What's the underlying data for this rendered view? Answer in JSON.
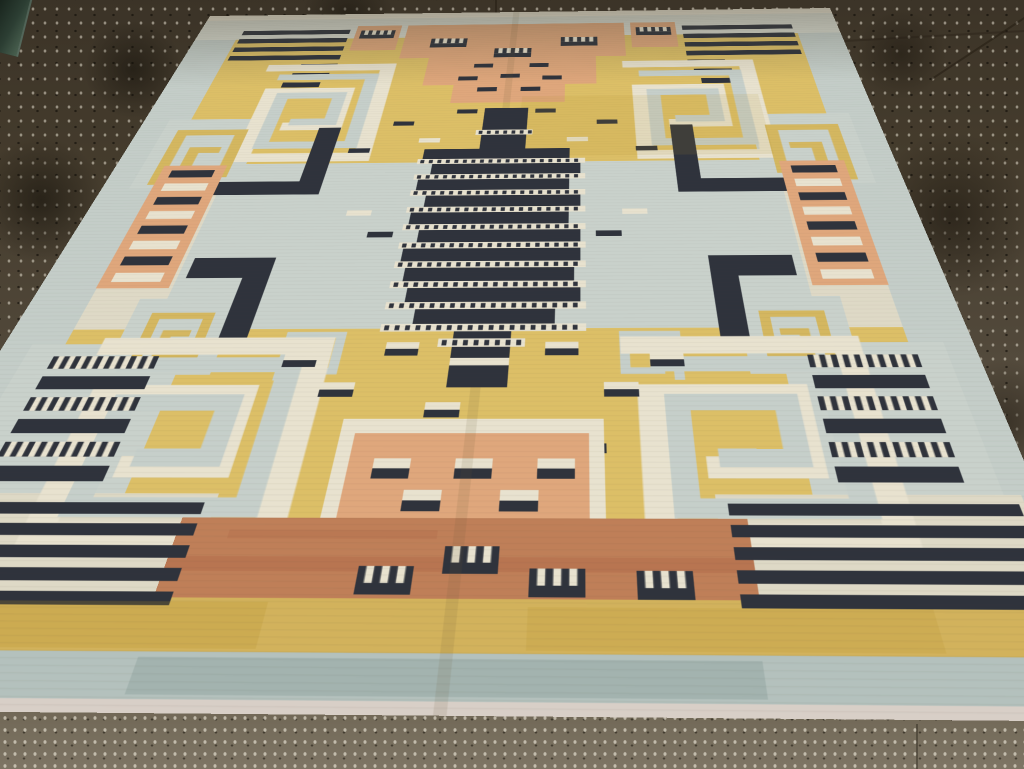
{
  "scene": {
    "type": "photograph",
    "subject": "Art Deco flat-weave dhurrie rug with geometric motifs, shown in perspective on a dark speckled concrete floor",
    "motif_vocabulary": [
      "greek-key spirals",
      "comb piano-key devices",
      "striped totem column",
      "salmon ladders",
      "stepped salmon blocks",
      "navy stripe stacks",
      "scattered two-tone dashes"
    ]
  },
  "palette": {
    "floor_top": "#3b3327",
    "floor_mid": "#6f6553",
    "floor_bottom": "#7d7464",
    "speckle_light": "rgba(238,232,216,0.5)",
    "speckle_dark": "rgba(15,12,7,0.6)",
    "grout": "#241e13",
    "cream": "#ded9c6",
    "cream_motif": "#e8e2cf",
    "selvage": "#e9e3d2",
    "white_band": "#d8dacf",
    "pale_edge": "#d8cfc7",
    "gray": "#c4cdc8",
    "gray_field": "#c9d1cb",
    "gray_deep": "#b4c1bd",
    "gray_key": "#c6cfca",
    "yellow": "#dcbf67",
    "yellow_deep": "#d2b25c",
    "yellow_key": "#d4b760",
    "gold": "#b8922f",
    "salmon": "#dfa77c",
    "terracotta": "#bf7f58",
    "red_streak": "#a85f41",
    "navy": "#2f333c",
    "teal_streak": "#7e948e",
    "fold": "#6b5a36"
  },
  "rug": {
    "size": [
      1000,
      1300
    ],
    "corners_px": [
      [
        210,
        16
      ],
      [
        830,
        8
      ],
      [
        1136,
        722
      ],
      [
        -225,
        710
      ]
    ],
    "zones": [
      {
        "x": 0,
        "y": 0,
        "w": 1000,
        "h": 1300,
        "c": "cream"
      },
      {
        "x": 0,
        "y": 0,
        "w": 1000,
        "h": 95,
        "c": "white_band"
      },
      {
        "x": 0,
        "y": 0,
        "w": 1000,
        "h": 20,
        "c": "selvage"
      },
      {
        "x": 0,
        "y": 95,
        "w": 65,
        "h": 1150,
        "c": "gray"
      },
      {
        "x": 935,
        "y": 95,
        "w": 65,
        "h": 1150,
        "c": "gray"
      },
      {
        "x": 65,
        "y": 95,
        "w": 870,
        "h": 390,
        "c": "yellow"
      },
      {
        "x": 150,
        "y": 485,
        "w": 700,
        "h": 350,
        "c": "gray_field"
      },
      {
        "x": 65,
        "y": 485,
        "w": 85,
        "h": 350,
        "c": "cream"
      },
      {
        "x": 850,
        "y": 485,
        "w": 85,
        "h": 350,
        "c": "cream"
      },
      {
        "x": 65,
        "y": 835,
        "w": 870,
        "h": 357,
        "c": "yellow"
      },
      {
        "x": 0,
        "y": 1192,
        "w": 1000,
        "h": 53,
        "c": "yellow_deep"
      },
      {
        "x": 0,
        "y": 1245,
        "w": 1000,
        "h": 43,
        "c": "gray_deep"
      },
      {
        "x": 0,
        "y": 1288,
        "w": 1000,
        "h": 12,
        "c": "pale_edge"
      },
      {
        "x": 35,
        "y": 360,
        "w": 135,
        "h": 185,
        "c": "gray_field"
      },
      {
        "x": 830,
        "y": 360,
        "w": 135,
        "h": 185,
        "c": "gray_field"
      },
      {
        "x": 120,
        "y": 780,
        "w": 110,
        "h": 130,
        "c": "gray_field"
      },
      {
        "x": 770,
        "y": 780,
        "w": 110,
        "h": 130,
        "c": "gray_field"
      },
      {
        "x": 30,
        "y": 860,
        "w": 165,
        "h": 235,
        "c": "gray_field"
      },
      {
        "x": 805,
        "y": 860,
        "w": 165,
        "h": 235,
        "c": "gray_field"
      },
      {
        "x": 15,
        "y": 1075,
        "w": 265,
        "h": 117,
        "c": "cream"
      },
      {
        "x": 720,
        "y": 1075,
        "w": 265,
        "h": 117,
        "c": "cream"
      }
    ],
    "motifs": [
      {
        "t": "stripes",
        "x": 70,
        "y": 62,
        "w": 170,
        "h": 16,
        "n": 4,
        "gap": 15,
        "c": "navy"
      },
      {
        "t": "stripes",
        "x": 760,
        "y": 62,
        "w": 170,
        "h": 16,
        "n": 4,
        "gap": 15,
        "c": "navy"
      },
      {
        "t": "dash",
        "x": 185,
        "y": 186,
        "w": 55,
        "h": 16
      },
      {
        "t": "dash",
        "x": 178,
        "y": 217,
        "w": 55,
        "h": 16
      },
      {
        "t": "dash",
        "x": 170,
        "y": 248,
        "w": 55,
        "h": 16
      },
      {
        "t": "dash",
        "x": 760,
        "y": 186,
        "w": 55,
        "h": 16
      },
      {
        "t": "dash",
        "x": 767,
        "y": 217,
        "w": 55,
        "h": 16
      },
      {
        "t": "dash",
        "x": 775,
        "y": 248,
        "w": 55,
        "h": 16
      },
      {
        "t": "rect",
        "x": 250,
        "y": 48,
        "w": 70,
        "h": 92,
        "c": "salmon"
      },
      {
        "t": "rect",
        "x": 680,
        "y": 48,
        "w": 70,
        "h": 92,
        "c": "salmon"
      },
      {
        "t": "comb",
        "x": 258,
        "y": 66,
        "w": 54,
        "h": 30,
        "s": 0.45
      },
      {
        "t": "comb",
        "x": 688,
        "y": 66,
        "w": 54,
        "h": 30,
        "s": 0.45
      },
      {
        "t": "rect",
        "x": 330,
        "y": 48,
        "w": 340,
        "h": 122,
        "c": "salmon"
      },
      {
        "t": "rect",
        "x": 375,
        "y": 170,
        "w": 250,
        "h": 92,
        "c": "salmon"
      },
      {
        "t": "rect",
        "x": 420,
        "y": 262,
        "w": 160,
        "h": 56,
        "c": "salmon"
      },
      {
        "t": "comb",
        "x": 372,
        "y": 100,
        "w": 56,
        "h": 32,
        "s": 0.45
      },
      {
        "t": "comb",
        "x": 572,
        "y": 100,
        "w": 56,
        "h": 32,
        "s": 0.45
      },
      {
        "t": "comb",
        "x": 472,
        "y": 138,
        "w": 56,
        "h": 32,
        "s": 0.45
      },
      {
        "t": "dash",
        "x": 445,
        "y": 192,
        "w": 28,
        "h": 13
      },
      {
        "t": "dash",
        "x": 527,
        "y": 192,
        "w": 28,
        "h": 13
      },
      {
        "t": "dash",
        "x": 425,
        "y": 234,
        "w": 28,
        "h": 13
      },
      {
        "t": "dash",
        "x": 486,
        "y": 227,
        "w": 28,
        "h": 13
      },
      {
        "t": "dash",
        "x": 547,
        "y": 234,
        "w": 28,
        "h": 13
      },
      {
        "t": "dash",
        "x": 455,
        "y": 270,
        "w": 28,
        "h": 13
      },
      {
        "t": "dash",
        "x": 517,
        "y": 270,
        "w": 28,
        "h": 13
      },
      {
        "t": "spiral",
        "x": 140,
        "y": 166,
        "w": 193,
        "h": 329
      },
      {
        "t": "spiral",
        "x": 667,
        "y": 166,
        "w": 193,
        "h": 329
      },
      {
        "t": "key",
        "x": 55,
        "y": 381,
        "w": 97,
        "h": 147,
        "c": "yellow_key"
      },
      {
        "t": "key",
        "x": 848,
        "y": 381,
        "w": 97,
        "h": 147,
        "c": "yellow_key",
        "f": 1
      },
      {
        "t": "rect",
        "x": 248,
        "y": 388,
        "w": 30,
        "h": 174,
        "c": "navy"
      },
      {
        "t": "rect",
        "x": 141,
        "y": 530,
        "w": 137,
        "h": 32,
        "c": "navy"
      },
      {
        "t": "rect",
        "x": 722,
        "y": 388,
        "w": 30,
        "h": 174,
        "c": "navy"
      },
      {
        "t": "rect",
        "x": 722,
        "y": 530,
        "w": 137,
        "h": 32,
        "c": "navy"
      },
      {
        "t": "rect",
        "x": 160,
        "y": 701,
        "w": 94,
        "h": 40,
        "c": "navy"
      },
      {
        "t": "rect",
        "x": 224,
        "y": 701,
        "w": 30,
        "h": 169,
        "c": "navy"
      },
      {
        "t": "rect",
        "x": 746,
        "y": 701,
        "w": 94,
        "h": 40,
        "c": "navy"
      },
      {
        "t": "rect",
        "x": 746,
        "y": 701,
        "w": 30,
        "h": 169,
        "c": "navy"
      },
      {
        "t": "ladder",
        "x": 64,
        "y": 488,
        "w": 82,
        "h": 272
      },
      {
        "t": "ladder",
        "x": 854,
        "y": 488,
        "w": 82,
        "h": 272
      },
      {
        "t": "key",
        "x": 141,
        "y": 800,
        "w": 69,
        "h": 93,
        "c": "yellow_key"
      },
      {
        "t": "key",
        "x": 790,
        "y": 800,
        "w": 69,
        "h": 93,
        "c": "yellow_key",
        "f": 1
      },
      {
        "t": "key",
        "x": 295,
        "y": 836,
        "w": 63,
        "h": 78,
        "c": "gray_key"
      },
      {
        "t": "key",
        "x": 642,
        "y": 836,
        "w": 63,
        "h": 78,
        "c": "gray_key",
        "f": 1
      },
      {
        "t": "spiral",
        "x": 108,
        "y": 832,
        "w": 245,
        "h": 317
      },
      {
        "t": "spiral",
        "x": 647,
        "y": 832,
        "w": 245,
        "h": 317
      },
      {
        "t": "dash",
        "x": 348,
        "y": 372,
        "w": 28,
        "h": 12
      },
      {
        "t": "dash",
        "x": 624,
        "y": 372,
        "w": 28,
        "h": 12
      },
      {
        "t": "dash",
        "x": 298,
        "y": 446,
        "w": 28,
        "h": 12
      },
      {
        "t": "dash",
        "x": 674,
        "y": 446,
        "w": 28,
        "h": 12
      },
      {
        "t": "dash",
        "x": 432,
        "y": 338,
        "w": 28,
        "h": 12
      },
      {
        "t": "dash",
        "x": 540,
        "y": 338,
        "w": 28,
        "h": 12
      },
      {
        "t": "cdash",
        "x": 388,
        "y": 420,
        "w": 28,
        "h": 12
      },
      {
        "t": "cdash",
        "x": 584,
        "y": 420,
        "w": 28,
        "h": 12
      },
      {
        "t": "cdash",
        "x": 320,
        "y": 600,
        "w": 30,
        "h": 12
      },
      {
        "t": "cdash",
        "x": 652,
        "y": 600,
        "w": 30,
        "h": 12
      },
      {
        "t": "dash",
        "x": 352,
        "y": 648,
        "w": 30,
        "h": 12
      },
      {
        "t": "dash",
        "x": 620,
        "y": 648,
        "w": 30,
        "h": 12
      },
      {
        "t": "dash2",
        "x": 402,
        "y": 858,
        "w": 34,
        "h": 22
      },
      {
        "t": "dash2",
        "x": 566,
        "y": 858,
        "w": 34,
        "h": 22
      },
      {
        "t": "dash2",
        "x": 345,
        "y": 922,
        "w": 34,
        "h": 22
      },
      {
        "t": "dash2",
        "x": 625,
        "y": 922,
        "w": 34,
        "h": 22
      },
      {
        "t": "dash2",
        "x": 452,
        "y": 952,
        "w": 34,
        "h": 22
      },
      {
        "t": "dash2",
        "x": 548,
        "y": 988,
        "w": 34,
        "h": 22
      },
      {
        "t": "dash2",
        "x": 300,
        "y": 876,
        "w": 34,
        "h": 22
      },
      {
        "t": "dash2",
        "x": 672,
        "y": 876,
        "w": 34,
        "h": 22
      },
      {
        "t": "dash",
        "x": 380,
        "y": 1010,
        "w": 30,
        "h": 13
      },
      {
        "t": "dash",
        "x": 596,
        "y": 1010,
        "w": 30,
        "h": 13
      },
      {
        "t": "rect",
        "x": 376,
        "y": 976,
        "w": 248,
        "h": 20,
        "c": "cream_motif"
      },
      {
        "t": "rect",
        "x": 376,
        "y": 976,
        "w": 14,
        "h": 128,
        "c": "cream_motif"
      },
      {
        "t": "rect",
        "x": 610,
        "y": 976,
        "w": 14,
        "h": 128,
        "c": "cream_motif"
      },
      {
        "t": "rect",
        "x": 390,
        "y": 996,
        "w": 220,
        "h": 108,
        "c": "salmon"
      },
      {
        "t": "rect",
        "x": 255,
        "y": 1104,
        "w": 490,
        "h": 88,
        "c": "terracotta"
      },
      {
        "t": "rect",
        "x": 255,
        "y": 1148,
        "w": 490,
        "h": 16,
        "c": "red_streak",
        "o": 0.3
      },
      {
        "t": "rect",
        "x": 300,
        "y": 1118,
        "w": 180,
        "h": 10,
        "c": "red_streak",
        "o": 0.2
      },
      {
        "t": "dash2",
        "x": 413,
        "y": 1030,
        "w": 34,
        "h": 26
      },
      {
        "t": "dash2",
        "x": 488,
        "y": 1030,
        "w": 34,
        "h": 26
      },
      {
        "t": "dash2",
        "x": 563,
        "y": 1030,
        "w": 34,
        "h": 26
      },
      {
        "t": "dash2",
        "x": 445,
        "y": 1070,
        "w": 34,
        "h": 26
      },
      {
        "t": "dash2",
        "x": 531,
        "y": 1070,
        "w": 34,
        "h": 26
      },
      {
        "t": "comb",
        "x": 418,
        "y": 1158,
        "w": 46,
        "h": 30,
        "s": 0.4
      },
      {
        "t": "comb",
        "x": 488,
        "y": 1136,
        "w": 46,
        "h": 30,
        "s": 0.4
      },
      {
        "t": "comb",
        "x": 560,
        "y": 1160,
        "w": 46,
        "h": 30,
        "s": 0.4
      },
      {
        "t": "comb",
        "x": 648,
        "y": 1162,
        "w": 46,
        "h": 30,
        "s": 0.4
      },
      {
        "t": "stripes",
        "x": 20,
        "y": 1086,
        "w": 250,
        "h": 14,
        "n": 5,
        "gap": 11,
        "c": "navy"
      },
      {
        "t": "stripes",
        "x": 730,
        "y": 1086,
        "w": 250,
        "h": 14,
        "n": 5,
        "gap": 11,
        "c": "navy"
      },
      {
        "t": "comb",
        "x": 60,
        "y": 880,
        "w": 110,
        "h": 20,
        "s": 0
      },
      {
        "t": "dash",
        "x": 60,
        "y": 912,
        "w": 110,
        "h": 20
      },
      {
        "t": "comb",
        "x": 60,
        "y": 944,
        "w": 110,
        "h": 20,
        "s": 0
      },
      {
        "t": "dash",
        "x": 60,
        "y": 976,
        "w": 110,
        "h": 20
      },
      {
        "t": "comb",
        "x": 60,
        "y": 1008,
        "w": 110,
        "h": 20,
        "s": 0
      },
      {
        "t": "dash",
        "x": 60,
        "y": 1040,
        "w": 110,
        "h": 20
      },
      {
        "t": "comb",
        "x": 830,
        "y": 880,
        "w": 110,
        "h": 20,
        "s": 0
      },
      {
        "t": "dash",
        "x": 830,
        "y": 912,
        "w": 110,
        "h": 20
      },
      {
        "t": "comb",
        "x": 830,
        "y": 944,
        "w": 110,
        "h": 20,
        "s": 0
      },
      {
        "t": "dash",
        "x": 830,
        "y": 976,
        "w": 110,
        "h": 20
      },
      {
        "t": "comb",
        "x": 830,
        "y": 1008,
        "w": 110,
        "h": 20,
        "s": 0
      },
      {
        "t": "dash",
        "x": 830,
        "y": 1040,
        "w": 110,
        "h": 20
      },
      {
        "t": "rect",
        "x": 520,
        "y": 300,
        "w": 330,
        "h": 170,
        "c": "gold",
        "o": 0.12
      },
      {
        "t": "rect",
        "x": 90,
        "y": 1196,
        "w": 260,
        "h": 46,
        "c": "gold",
        "o": 0.22
      },
      {
        "t": "rect",
        "x": 560,
        "y": 1200,
        "w": 320,
        "h": 42,
        "c": "gold",
        "o": 0.18
      },
      {
        "t": "rect",
        "x": 260,
        "y": 1250,
        "w": 480,
        "h": 34,
        "c": "teal_streak",
        "o": 0.3
      },
      {
        "t": "rect",
        "x": 494,
        "y": 0,
        "w": 10,
        "h": 1300,
        "c": "fold",
        "o": 0.12
      }
    ],
    "totem": {
      "spine": [
        470,
        335,
        60,
        595
      ],
      "cap_dot": [
        462,
        398,
        76,
        14
      ],
      "rung_h": 26,
      "dot": [
        392,
        216,
        13
      ],
      "rungs": [
        [
          398,
          450,
          190
        ],
        [
          412,
          489,
          190
        ],
        [
          398,
          528,
          190
        ],
        [
          412,
          567,
          190
        ],
        [
          398,
          606,
          190
        ],
        [
          412,
          645,
          190
        ],
        [
          398,
          684,
          204
        ],
        [
          405,
          723,
          190
        ],
        [
          412,
          762,
          190
        ],
        [
          425,
          801,
          150
        ]
      ],
      "tail_dot": [
        455,
        852,
        90,
        14
      ],
      "tail_dash2": [
        470,
        884,
        60,
        24
      ]
    }
  }
}
